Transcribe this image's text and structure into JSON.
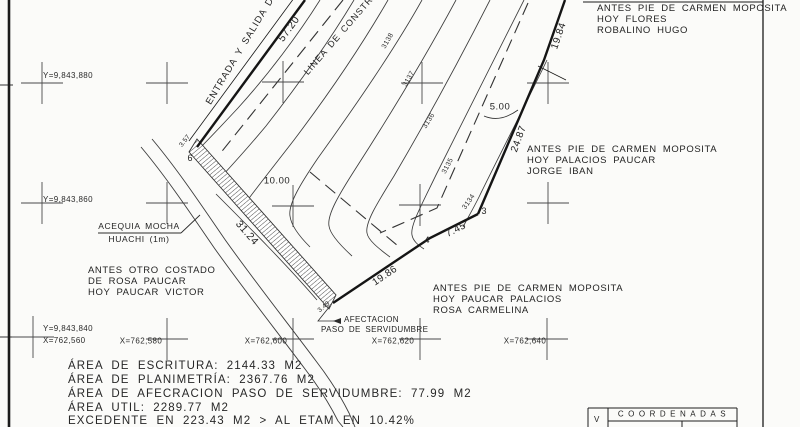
{
  "plan": {
    "street_label": "ENTRADA Y SALIDA DE",
    "construction_line_label": "LINEA DE CONSTRUCCION",
    "dims": {
      "street": "57.20",
      "right_upper": "19.84",
      "right_lower": "24.87",
      "seg_3_4": "7.45",
      "bottom": "19.86",
      "strip": "31.24",
      "setback_street": "10.00",
      "setback_right": "5.00",
      "strip_top": "3.57",
      "strip_tip": "3.49"
    },
    "vertices": {
      "v6": "6",
      "v4": "4",
      "v3": "3"
    },
    "contours": [
      "3138",
      "3137",
      "3136",
      "3135",
      "3134"
    ],
    "grid": {
      "y_labels": [
        "Y=9,843,880",
        "Y=9,843,860",
        "Y=9,843,840"
      ],
      "x_labels": [
        "X=762,560",
        "X=762,580",
        "X=762,600",
        "X=762,620",
        "X=762,640"
      ]
    },
    "acequia": {
      "line1": "ACEQUIA MOCHA",
      "line2": "HUACHI (1m)"
    },
    "servidumbre_callout": {
      "line1": "AFECTACION",
      "line2": "PASO DE SERVIDUMBRE"
    },
    "neighbors": {
      "north": {
        "lines": [
          "ANTES PIE DE CARMEN MOPOSITA",
          "HOY FLORES",
          "ROBALINO HUGO"
        ]
      },
      "east": {
        "lines": [
          "ANTES PIE DE CARMEN MOPOSITA",
          "HOY PALACIOS PAUCAR",
          "JORGE IBAN"
        ]
      },
      "south": {
        "lines": [
          "ANTES PIE DE CARMEN MOPOSITA",
          "HOY PAUCAR PALACIOS",
          "ROSA CARMELINA"
        ]
      },
      "west": {
        "lines": [
          "ANTES OTRO COSTADO",
          "DE ROSA PAUCAR",
          "HOY PAUCAR VICTOR"
        ]
      }
    },
    "areas": {
      "line1": "ÁREA DE ESCRITURA: 2144.33 M2",
      "line2": "ÁREA DE PLANIMETRÍA:  2367.76 M2",
      "line3": "ÁREA DE AFECRACION PASO DE SERVIDUMBRE:  77.99 M2",
      "line4": "ÁREA UTIL:  2289.77 M2",
      "line5": "EXCEDENTE EN 223.43 M2 > AL ETAM EN 10.42%"
    },
    "table": {
      "v": "V",
      "header": "COORDENADAS"
    }
  }
}
